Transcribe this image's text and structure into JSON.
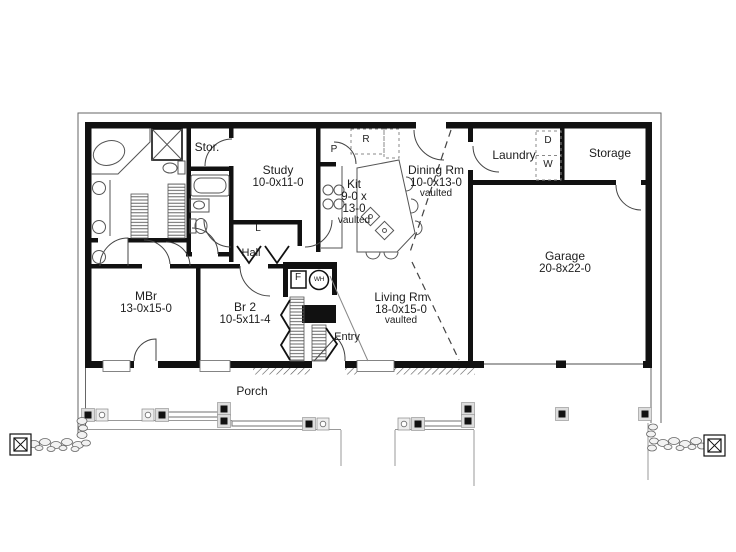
{
  "rooms": {
    "stor": {
      "name": "Stor."
    },
    "study": {
      "name": "Study",
      "dims": "10-0x11-0"
    },
    "kit": {
      "name": "Kit",
      "dims1": "9-0 x",
      "dims2": "13-0",
      "note": "vaulted"
    },
    "dining": {
      "name": "Dining Rm",
      "dims": "10-0x13-0",
      "note": "vaulted"
    },
    "laundry": {
      "name": "Laundry"
    },
    "storage": {
      "name": "Storage"
    },
    "garage": {
      "name": "Garage",
      "dims": "20-8x22-0"
    },
    "mbr": {
      "name": "MBr",
      "dims": "13-0x15-0"
    },
    "br2": {
      "name": "Br 2",
      "dims": "10-5x11-4"
    },
    "living": {
      "name": "Living Rm",
      "dims": "18-0x15-0",
      "note": "vaulted"
    },
    "hall": {
      "name": "Hall"
    },
    "entry": {
      "name": "Entry"
    },
    "porch": {
      "name": "Porch"
    },
    "linen": {
      "abbr": "L"
    }
  },
  "markers": {
    "pantry": "P",
    "refrigerator": "R",
    "dryer": "D",
    "washer": "W",
    "furnace": "F",
    "water_heater": "WH"
  },
  "colors": {
    "wall": "#111111",
    "fixture_line": "#555555",
    "light_line": "#999999",
    "background": "#ffffff",
    "text": "#1d1d1d"
  }
}
